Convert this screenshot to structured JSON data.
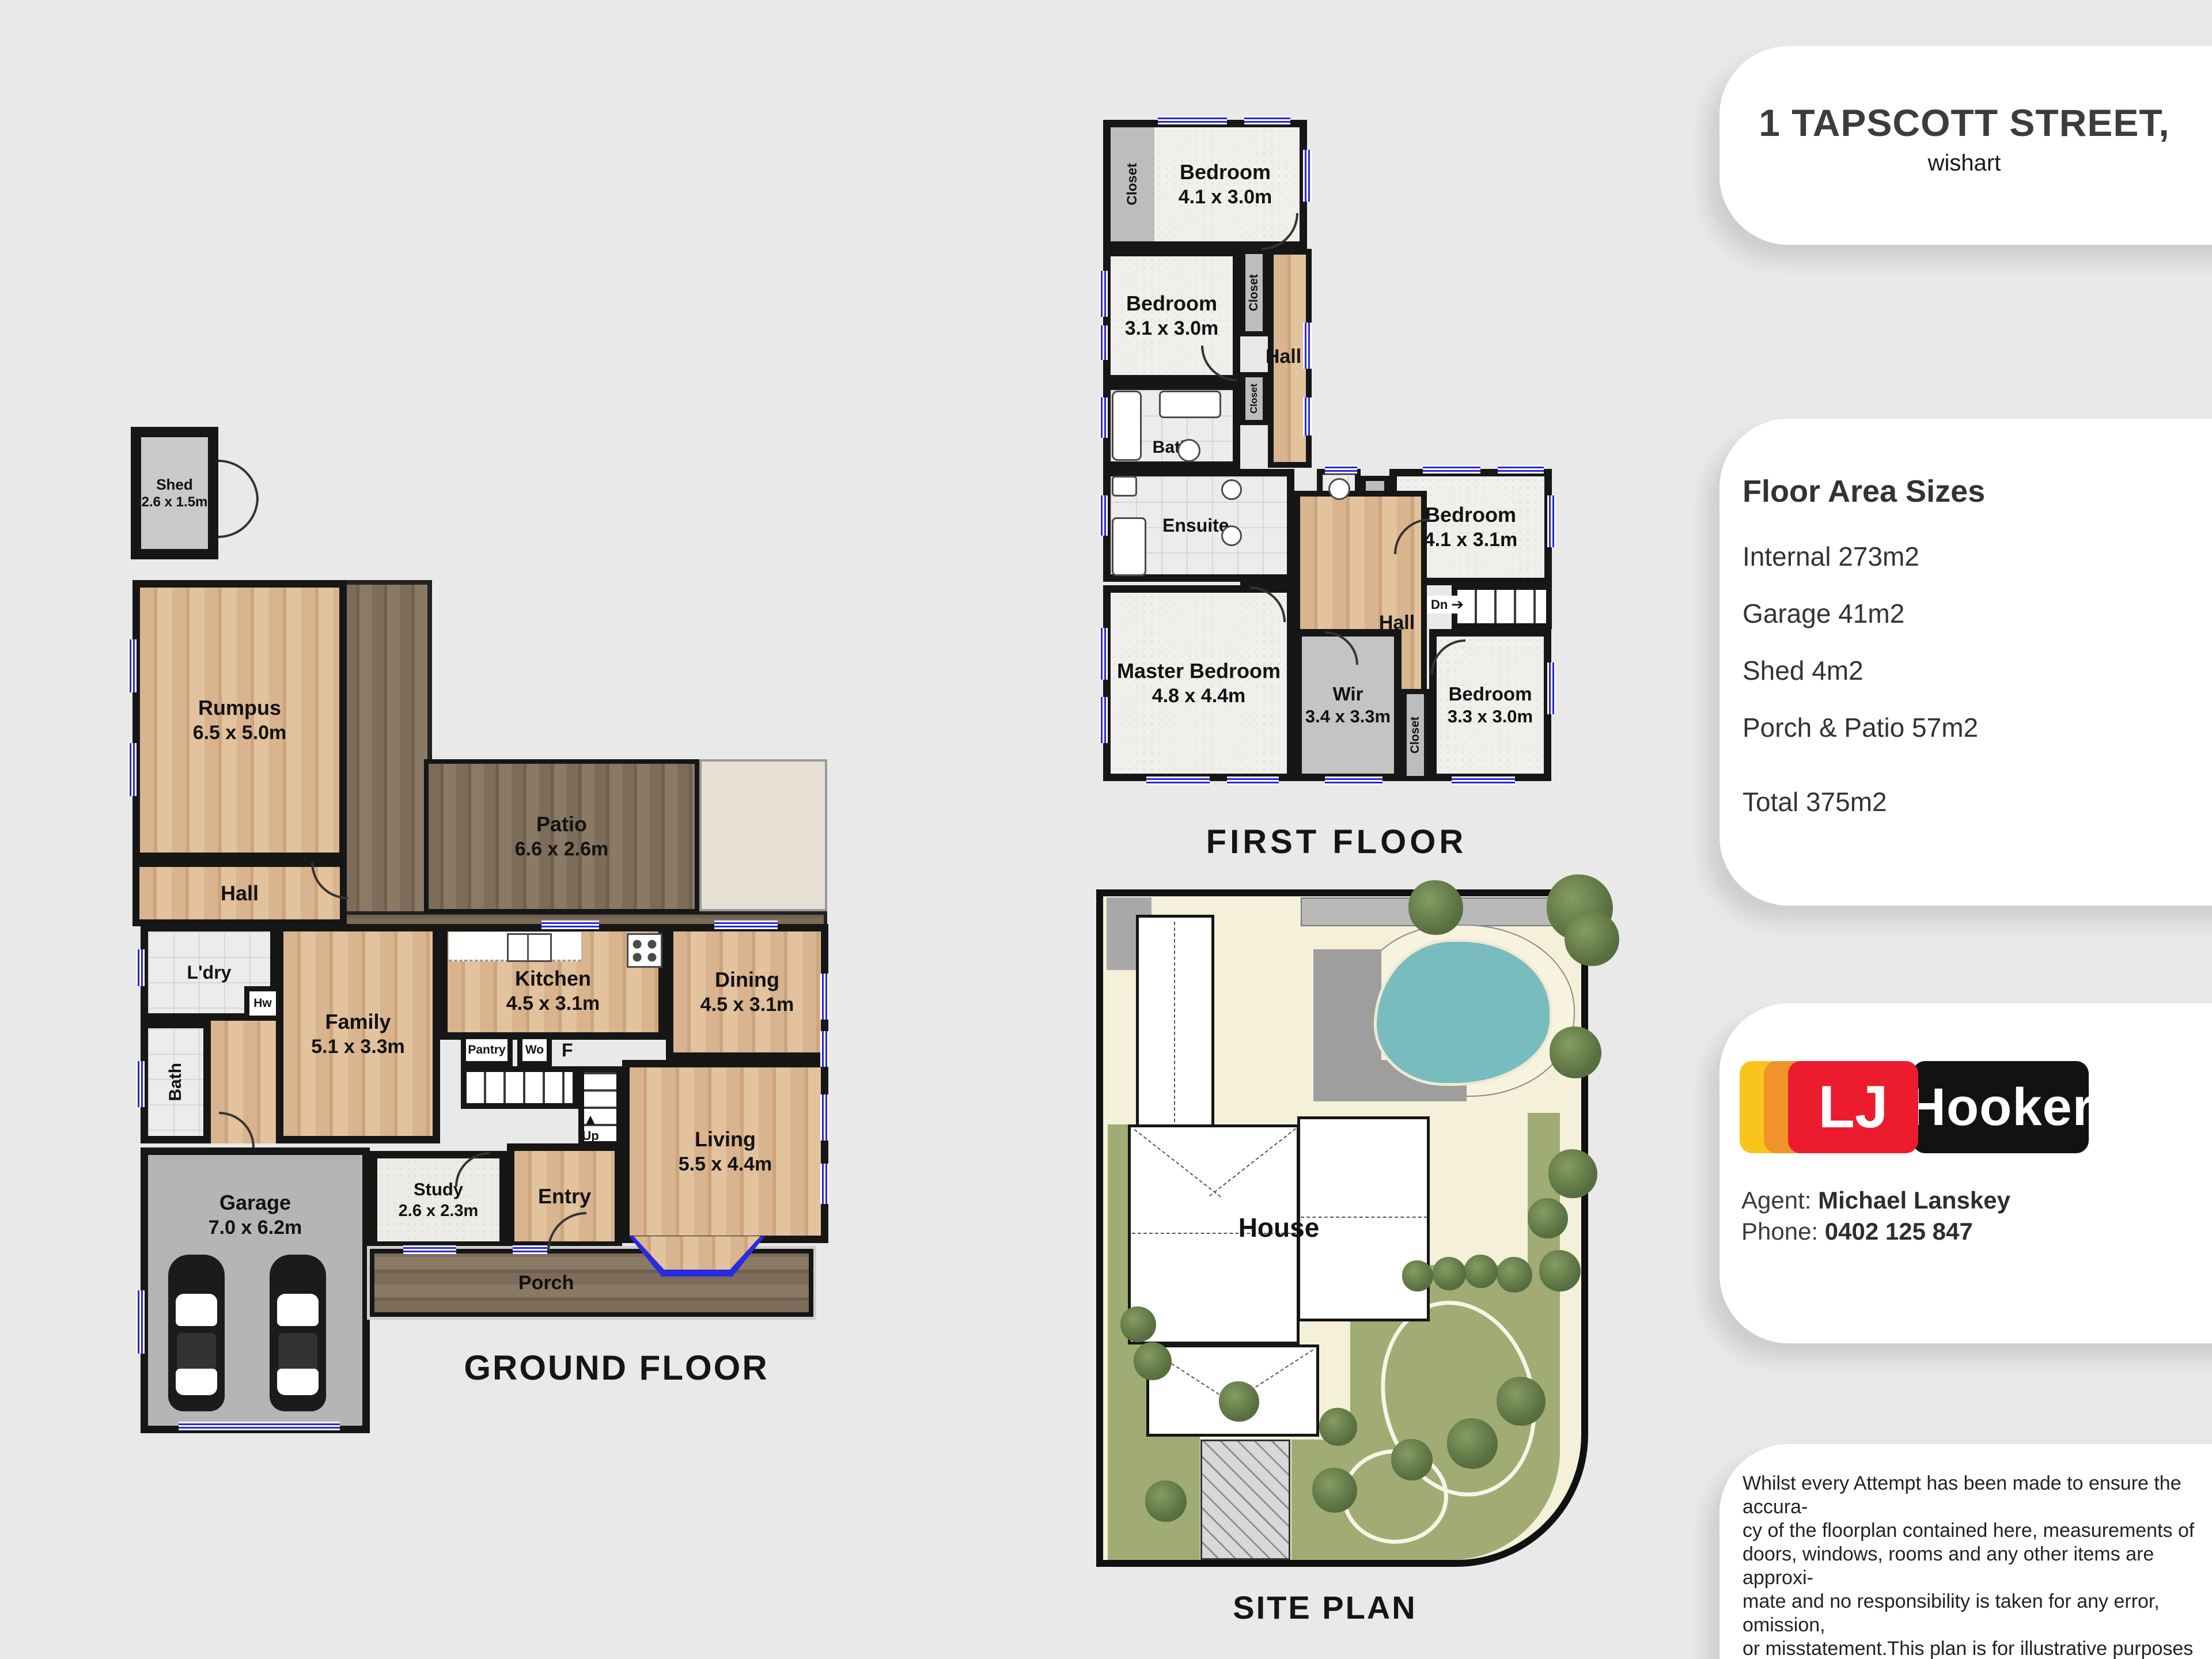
{
  "sidebar": {
    "address": {
      "line1": "1 TAPSCOTT STREET,",
      "line2": "wishart"
    },
    "floor_areas": {
      "heading": "Floor Area Sizes",
      "items": [
        "Internal 273m2",
        "Garage 41m2",
        "Shed 4m2",
        "Porch & Patio 57m2"
      ],
      "total": "Total 375m2"
    },
    "brand": {
      "lj": "LJ",
      "hooker": "Hooker",
      "colors": {
        "yellow": "#F9C51D",
        "orange": "#F0932B",
        "red": "#EC1B2E",
        "black": "#121212"
      }
    },
    "agent": {
      "label": "Agent:",
      "name": "Michael Lanskey",
      "phone_label": "Phone:",
      "phone": "0402 125 847"
    },
    "disclaimer_lines": [
      "Whilst every Attempt has been made to ensure the accura-",
      "cy of the floorplan contained here,  measurements of",
      "doors, windows, rooms and any other items are approxi-",
      "mate and no responsibility is taken for any error, omission,",
      "or misstatement.This plan is for illustrative purposes only",
      "and should be used as such by any prospective purchaser."
    ]
  },
  "ground_floor": {
    "title": "GROUND FLOOR",
    "shed": {
      "name": "Shed",
      "dims": "2.6 x 1.5m"
    },
    "rumpus": {
      "name": "Rumpus",
      "dims": "6.5 x 5.0m"
    },
    "patio": {
      "name": "Patio",
      "dims": "6.6 x 2.6m"
    },
    "hall": "Hall",
    "ldry": "L'dry",
    "hw": "Hw",
    "bath": "Bath",
    "family": {
      "name": "Family",
      "dims": "5.1 x 3.3m"
    },
    "kitchen": {
      "name": "Kitchen",
      "dims": "4.5 x 3.1m"
    },
    "pantry": "Pantry",
    "wo": "Wo",
    "fridge": "F",
    "dining": {
      "name": "Dining",
      "dims": "4.5 x 3.1m"
    },
    "living": {
      "name": "Living",
      "dims": "5.5 x 4.4m"
    },
    "entry": "Entry",
    "study": {
      "name": "Study",
      "dims": "2.6 x 2.3m"
    },
    "garage": {
      "name": "Garage",
      "dims": "7.0 x 6.2m"
    },
    "porch": "Porch",
    "up": "Up",
    "up_arrow": "▲"
  },
  "first_floor": {
    "title": "FIRST FLOOR",
    "bedroom1": {
      "name": "Bedroom",
      "dims": "4.1 x 3.0m"
    },
    "bedroom2": {
      "name": "Bedroom",
      "dims": "3.1 x 3.0m"
    },
    "bedroom3": {
      "name": "Bedroom",
      "dims": "4.1 x 3.1m"
    },
    "bedroom4": {
      "name": "Bedroom",
      "dims": "3.3 x 3.0m"
    },
    "master": {
      "name": "Master Bedroom",
      "dims": "4.8 x 4.4m"
    },
    "wir": {
      "name": "Wir",
      "dims": "3.4 x 3.3m"
    },
    "bath": "Bath",
    "ensuite": "Ensuite",
    "wc": "Wc",
    "hall": "Hall",
    "closet": "Closet",
    "dn": "Dn",
    "dn_arrow": "➔"
  },
  "site_plan": {
    "title": "SITE PLAN",
    "house": "House"
  }
}
